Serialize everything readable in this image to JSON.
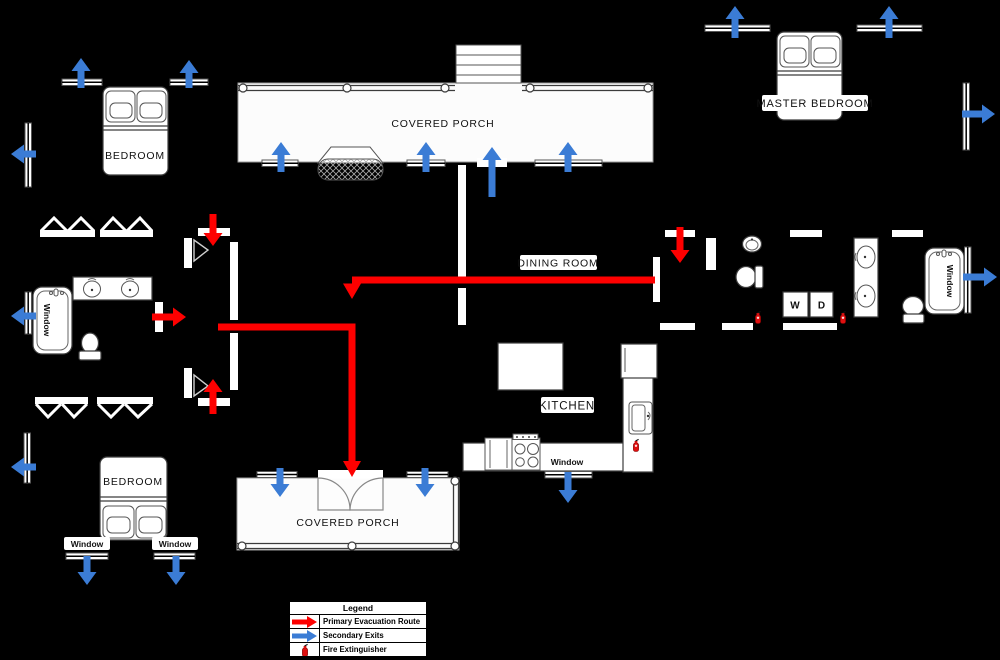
{
  "palette": {
    "background": "#000000",
    "wall_color": "#ffffff",
    "primary_route_color": "#fe0000",
    "secondary_exit_color": "#3b7cd5"
  },
  "rooms": {
    "bedroom_top_left": "BEDROOM",
    "master_bedroom": "MASTER BEDROOM",
    "covered_porch_top": "COVERED PORCH",
    "dining_room": "DINING ROOM",
    "kitchen": "KITCHEN",
    "bedroom_bottom": "BEDROOM",
    "covered_porch_bottom": "COVERED PORCH"
  },
  "labels": {
    "window": "Window",
    "washer": "W",
    "dryer": "D"
  },
  "legend": {
    "title": "Legend",
    "items": [
      {
        "icon": "primary-route-arrow-icon",
        "label": "Primary Evacuation Route"
      },
      {
        "icon": "secondary-exit-arrow-icon",
        "label": "Secondary Exits"
      },
      {
        "icon": "fire-extinguisher-icon",
        "label": "Fire Extinguisher"
      }
    ]
  }
}
